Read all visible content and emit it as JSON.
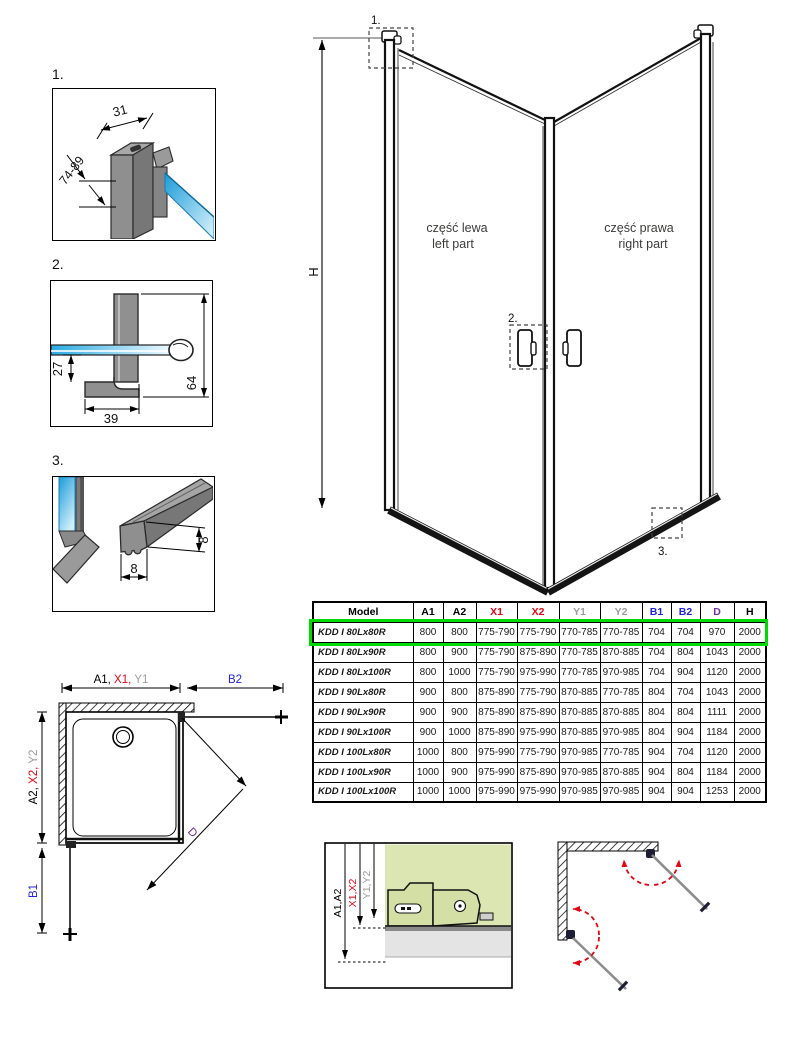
{
  "colors": {
    "red": "#e30613",
    "gray": "#9d9d9c",
    "blue": "#2323dd",
    "purple": "#7030a0",
    "highlight_green": "#00d900",
    "glass_blue": "#29abe2",
    "panel_green": "#dce6b2"
  },
  "details": [
    {
      "label": "1.",
      "dim_width": "31",
      "dim_range": "74-89"
    },
    {
      "label": "2.",
      "dim_depth": "27",
      "dim_width": "39",
      "dim_height": "64"
    },
    {
      "label": "3.",
      "dim_height": "8",
      "dim_width": "8"
    }
  ],
  "main_drawing": {
    "height_dim": "H",
    "callout_1": "1.",
    "callout_2": "2.",
    "callout_3": "3.",
    "left_part": {
      "pl": "część lewa",
      "en": "left part"
    },
    "right_part": {
      "pl": "część prawa",
      "en": "right part"
    }
  },
  "table": {
    "columns": [
      {
        "label": "Model",
        "color": "#000000"
      },
      {
        "label": "A1",
        "color": "#000000"
      },
      {
        "label": "A2",
        "color": "#000000"
      },
      {
        "label": "X1",
        "color": "#e30613"
      },
      {
        "label": "X2",
        "color": "#e30613"
      },
      {
        "label": "Y1",
        "color": "#9d9d9c"
      },
      {
        "label": "Y2",
        "color": "#9d9d9c"
      },
      {
        "label": "B1",
        "color": "#2323dd"
      },
      {
        "label": "B2",
        "color": "#2323dd"
      },
      {
        "label": "D",
        "color": "#7030a0"
      },
      {
        "label": "H",
        "color": "#000000"
      }
    ],
    "rows": [
      {
        "model": "KDD I 80Lx80R",
        "highlighted": true,
        "values": [
          "800",
          "800",
          "775-790",
          "775-790",
          "770-785",
          "770-785",
          "704",
          "704",
          "970",
          "2000"
        ]
      },
      {
        "model": "KDD I 80Lx90R",
        "highlighted": false,
        "values": [
          "800",
          "900",
          "775-790",
          "875-890",
          "770-785",
          "870-885",
          "704",
          "804",
          "1043",
          "2000"
        ]
      },
      {
        "model": "KDD I 80Lx100R",
        "highlighted": false,
        "values": [
          "800",
          "1000",
          "775-790",
          "975-990",
          "770-785",
          "970-985",
          "704",
          "904",
          "1120",
          "2000"
        ]
      },
      {
        "model": "KDD I 90Lx80R",
        "highlighted": false,
        "values": [
          "900",
          "800",
          "875-890",
          "775-790",
          "870-885",
          "770-785",
          "804",
          "704",
          "1043",
          "2000"
        ]
      },
      {
        "model": "KDD I 90Lx90R",
        "highlighted": false,
        "values": [
          "900",
          "900",
          "875-890",
          "875-890",
          "870-885",
          "870-885",
          "804",
          "804",
          "1111",
          "2000"
        ]
      },
      {
        "model": "KDD I 90Lx100R",
        "highlighted": false,
        "values": [
          "900",
          "1000",
          "875-890",
          "975-990",
          "870-885",
          "970-985",
          "804",
          "904",
          "1184",
          "2000"
        ]
      },
      {
        "model": "KDD I 100Lx80R",
        "highlighted": false,
        "values": [
          "1000",
          "800",
          "975-990",
          "775-790",
          "970-985",
          "770-785",
          "904",
          "704",
          "1120",
          "2000"
        ]
      },
      {
        "model": "KDD I 100Lx90R",
        "highlighted": false,
        "values": [
          "1000",
          "900",
          "975-990",
          "875-890",
          "970-985",
          "870-885",
          "904",
          "804",
          "1184",
          "2000"
        ]
      },
      {
        "model": "KDD I 100Lx100R",
        "highlighted": false,
        "values": [
          "1000",
          "1000",
          "975-990",
          "975-990",
          "970-985",
          "970-985",
          "904",
          "904",
          "1253",
          "2000"
        ]
      }
    ]
  },
  "top_view": {
    "dim_a1": "A1,",
    "dim_x1": " X1,",
    "dim_y1": " Y1",
    "dim_b2": "B2",
    "dim_a2": "A2,",
    "dim_x2": " X2,",
    "dim_y2": " Y2",
    "dim_b1": "B1",
    "dim_d": "D"
  },
  "section_view": {
    "dim_a": "A1,A2",
    "dim_x": "X1,X2",
    "dim_y": "Y1,Y2"
  }
}
